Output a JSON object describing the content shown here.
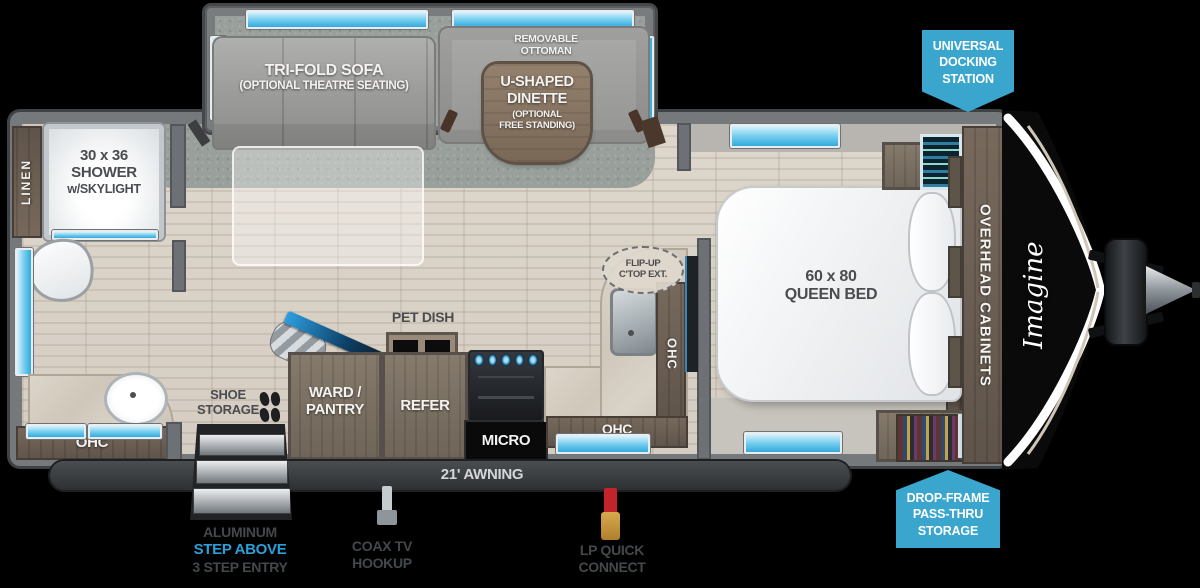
{
  "brand": {
    "logo": "Imagine"
  },
  "badges": {
    "docking": "UNIVERSAL DOCKING STATION",
    "storage": "DROP-FRAME PASS-THRU STORAGE"
  },
  "slide_out": {
    "sofa_label": "TRI-FOLD SOFA",
    "sofa_sublabel": "(OPTIONAL THEATRE SEATING)",
    "ottoman_label": "REMOVABLE OTTOMAN",
    "dinette_label_1": "U-SHAPED",
    "dinette_label_2": "DINETTE",
    "dinette_sublabel_1": "(OPTIONAL",
    "dinette_sublabel_2": "FREE STANDING)"
  },
  "bathroom": {
    "linen": "LINEN",
    "shower_1": "30 x 36",
    "shower_2": "SHOWER",
    "shower_3": "w/SKYLIGHT",
    "ohc": "OHC"
  },
  "kitchen": {
    "pet_dish": "PET DISH",
    "shoe_1": "SHOE",
    "shoe_2": "STORAGE",
    "ward_1": "WARD /",
    "ward_2": "PANTRY",
    "refer": "REFER",
    "micro": "MICRO",
    "flip_1": "FLIP-UP",
    "flip_2": "C'TOP EXT.",
    "ohc_side": "OHC",
    "ohc_bottom": "OHC"
  },
  "bedroom": {
    "bed_1": "60 x 80",
    "bed_2": "QUEEN BED",
    "overhead": "OVERHEAD CABINETS"
  },
  "exterior": {
    "awning": "21' AWNING",
    "step_1": "ALUMINUM",
    "step_2": "STEP ABOVE",
    "step_3": "3 STEP ENTRY",
    "coax_1": "COAX TV",
    "coax_2": "HOOKUP",
    "lp_1": "LP QUICK",
    "lp_2": "CONNECT"
  },
  "colors": {
    "badge_blue": "#3AA6CD",
    "step_text_blue": "#2B9FD8",
    "window_blue": "#6FCBEE",
    "awning_bar": "#2E3032",
    "wall_gray": "#75797C",
    "carpet_gray": "#99A09B"
  }
}
